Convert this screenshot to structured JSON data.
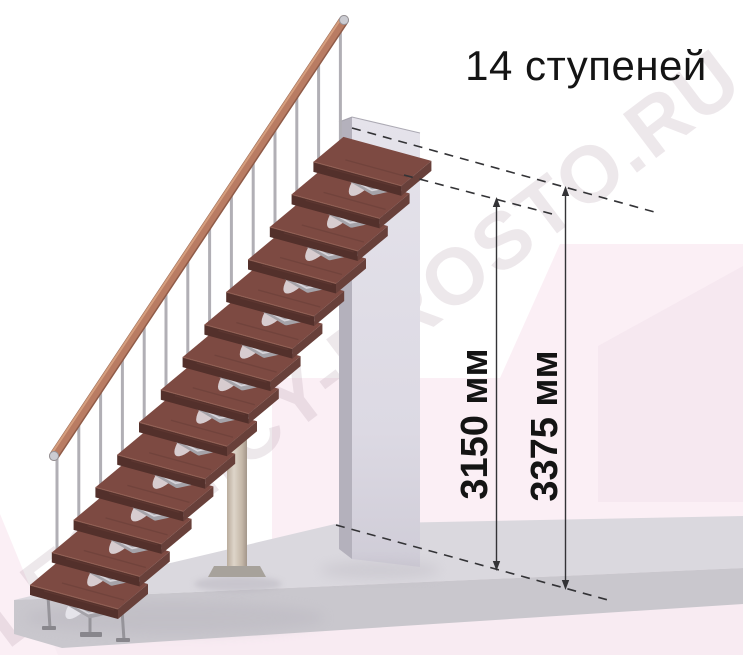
{
  "title": "14 ступеней",
  "watermark": {
    "text": "LESTNICY-PROSTO.RU"
  },
  "stairs": {
    "steps_count": 14
  },
  "dims": [
    {
      "label": "3150 мм"
    },
    {
      "label": "3375 мм"
    }
  ],
  "colors": {
    "text": "#141414",
    "dim_line": "#333336",
    "tread_top": "#7d4a42",
    "tread_front": "#53302b",
    "tread_side": "#68403a",
    "rail": "#b97c63",
    "metal": "#a8a6ac",
    "wall_front": "#dfdde6",
    "wall_side": "#b4b1bc",
    "floor_top": "#dad8de",
    "floor_front": "#c9c7cd",
    "bg_pink_1": "#fbeff5",
    "bg_pink_2": "#f3e3ec",
    "bg_pink_3": "#f8ebf2",
    "watermark": "#a98e9f"
  }
}
